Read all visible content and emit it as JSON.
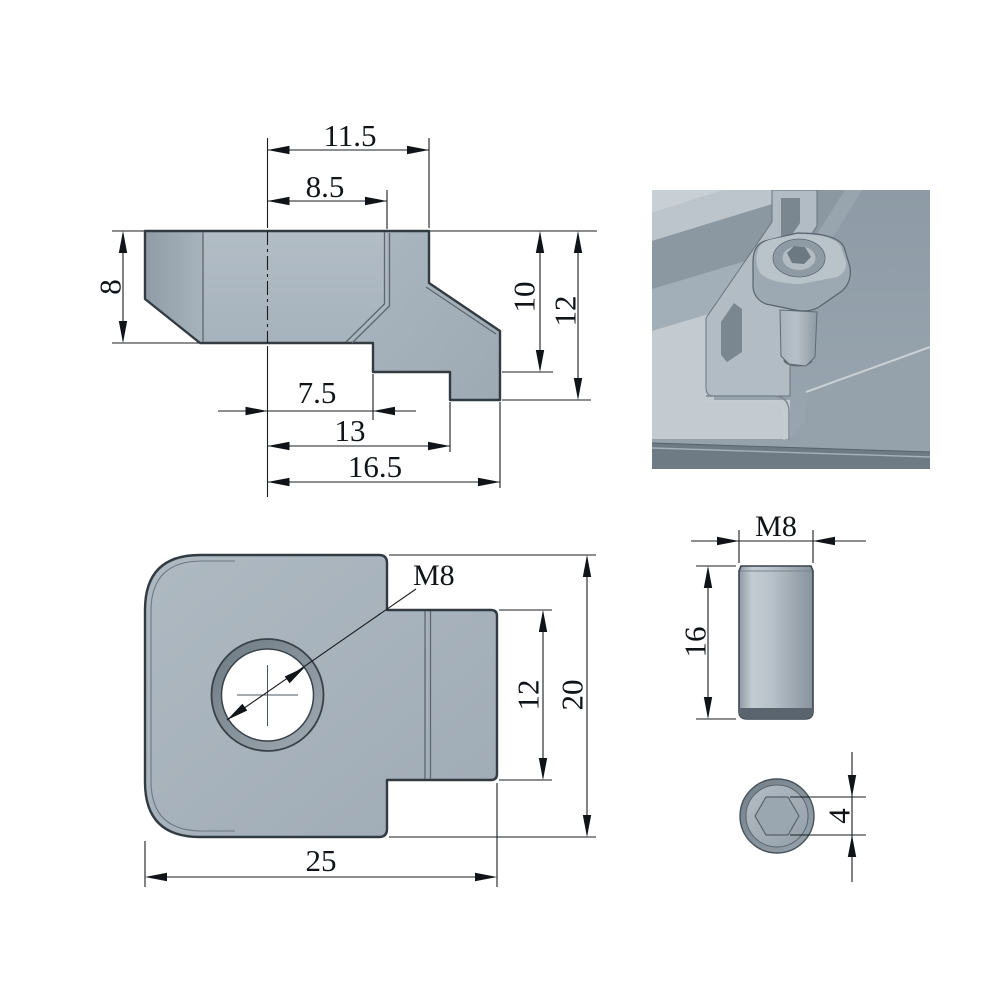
{
  "views": {
    "side_profile": {
      "dims": {
        "top_width": "11.5",
        "upper_width": "8.5",
        "left_height": "8",
        "bottom_step": "7.5",
        "bottom_mid": "13",
        "bottom_total": "16.5",
        "right_depth": "10",
        "right_total": "12"
      }
    },
    "top_plan": {
      "dims": {
        "thread_callout": "M8",
        "tab_height": "12",
        "total_height": "20",
        "total_width": "25"
      }
    },
    "stud_side": {
      "dims": {
        "thread_callout": "M8",
        "length": "16"
      }
    },
    "stud_end": {
      "dims": {
        "socket_width": "4"
      }
    }
  },
  "colors": {
    "part_fill": "#aab6c0",
    "part_fill_dark": "#97a3ac",
    "hole_ring": "#7d8993",
    "dimension_line": "#1a1d20",
    "render_panel": "#93a0ab",
    "render_light": "#c3cbd0"
  }
}
